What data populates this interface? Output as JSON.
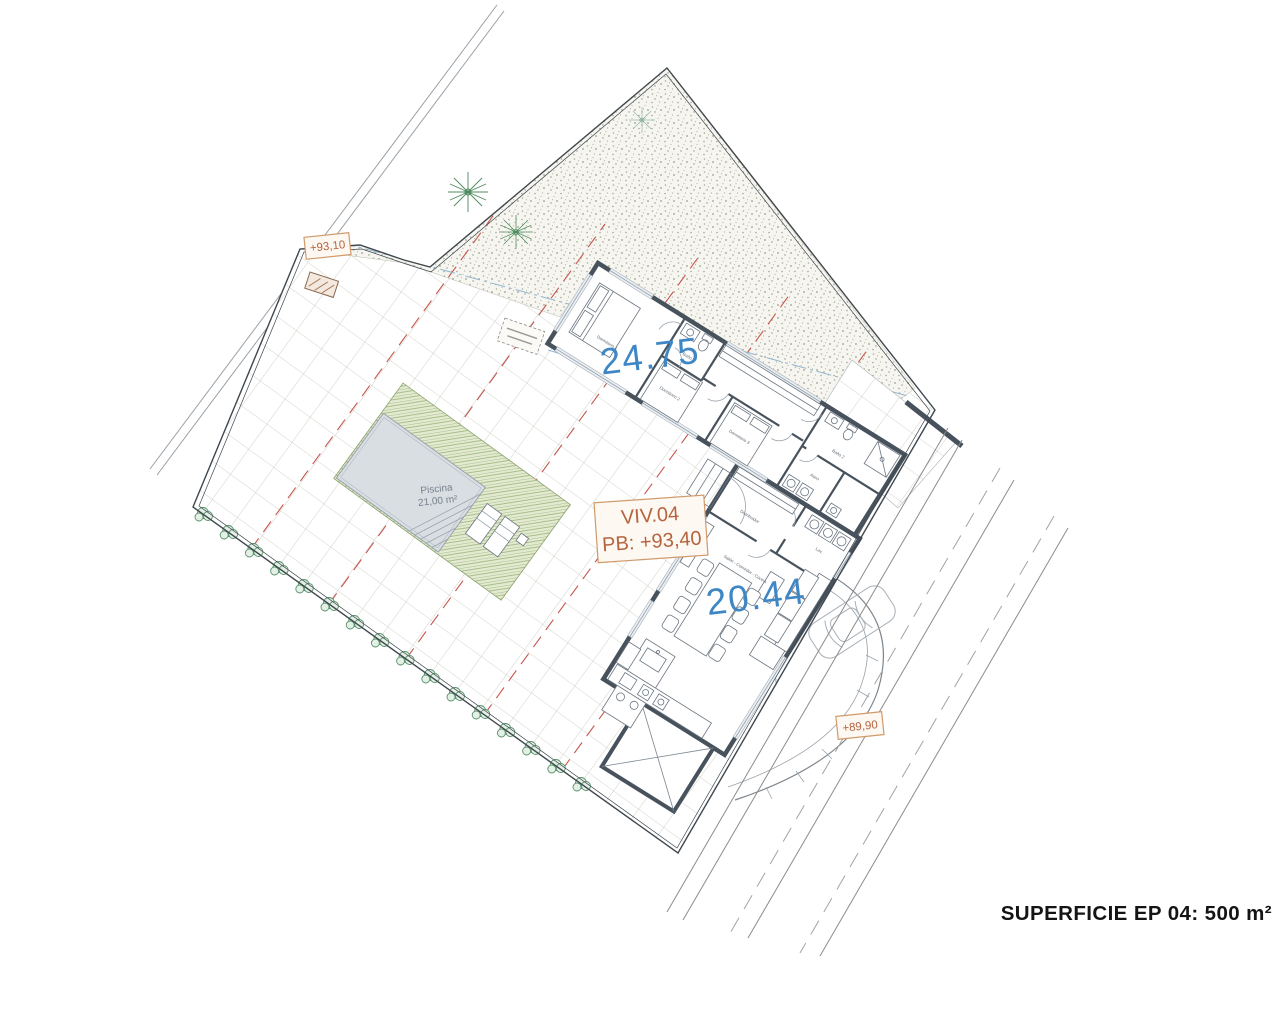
{
  "document": {
    "footer_label": "SUPERFICIE EP 04: 500 m²"
  },
  "unit_box": {
    "line1": "VIV.04",
    "line2": "PB: +93,40"
  },
  "area_labels": {
    "upper_wing": "24.75",
    "lower_wing": "20.44"
  },
  "elevation_markers": {
    "top_left": "+93,10",
    "bottom_right": "+89,90"
  },
  "pool": {
    "name": "Piscina",
    "area": "21,00 m²"
  },
  "rooms": {
    "dormitorio1": "Dormitorio 1",
    "dormitorio2": "Dormitorio 2",
    "dormitorio3": "Dormitorio 3",
    "bano1": "Baño 1",
    "bano2": "Baño 2",
    "aseo": "Aseo",
    "distribuidor": "Distribuidor",
    "salon": "Salón - Comedor - Cocina",
    "lavadero": "Lav."
  },
  "colors": {
    "area_label_blue": "#3f86c5",
    "annotation_orange": "#b5643f",
    "wall": "#47525c",
    "deck_green": "#9ab377",
    "pool_water": "#d9dee3",
    "setback_red": "#c4564e",
    "guide_blue": "#8fb6d2"
  }
}
